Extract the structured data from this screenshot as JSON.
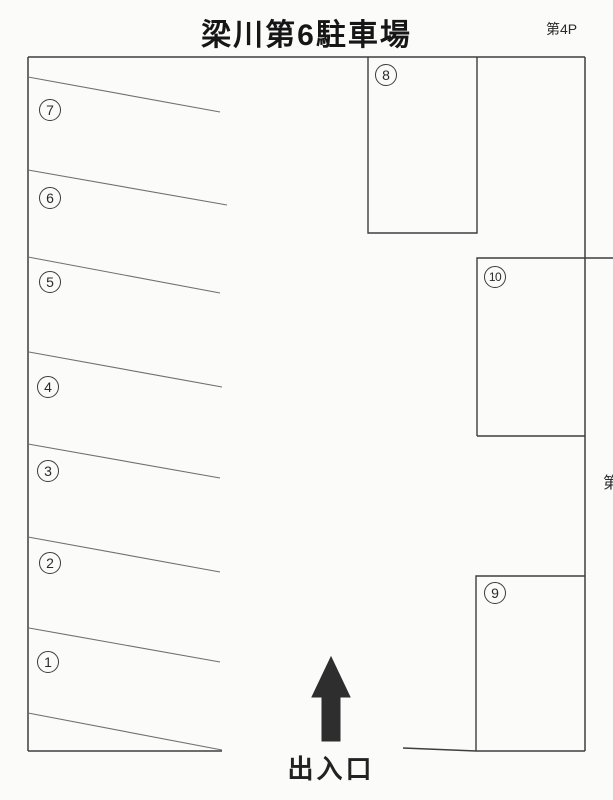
{
  "page": {
    "title": "梁川第6駐車場",
    "corner_label": "第4P",
    "adjacent_label_partial": "第",
    "entrance_label": "出入口"
  },
  "stalls": [
    {
      "number": "1"
    },
    {
      "number": "2"
    },
    {
      "number": "3"
    },
    {
      "number": "4"
    },
    {
      "number": "5"
    },
    {
      "number": "6"
    },
    {
      "number": "7"
    },
    {
      "number": "8"
    },
    {
      "number": "9"
    },
    {
      "number": "10"
    }
  ],
  "icons": {
    "entrance_arrow": "up-arrow"
  },
  "colors": {
    "background": "#fbfbfa",
    "outline": "#3e3e3e",
    "divider": "#6f6f6f",
    "arrow_fill": "#2e2e2e",
    "text": "#1c1c1c"
  }
}
